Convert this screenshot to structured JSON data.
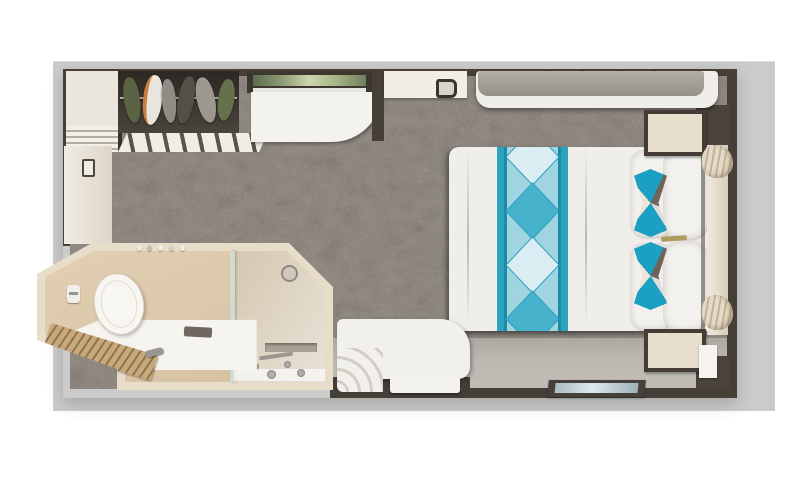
{
  "scene": {
    "kind": "cruise-stateroom-floorplan-3d-render",
    "areas": [
      "bedroom",
      "bathroom",
      "entry-vestibule"
    ],
    "contains_text": false
  },
  "palette": {
    "page_bg": "#ffffff",
    "deck_backdrop": "#cbcbca",
    "walls": "#463f38",
    "carpet": "#8e8780",
    "vinyl_floor": "#b7b2ac",
    "bathroom_wall": "#e8ddc9",
    "bathroom_floor": "#dcc8ad",
    "bed_linen": "#f0eeea",
    "runner_teal": "#2ba2be",
    "accent_teal": "#1b9fc2",
    "accent_taupe": "#6e6459",
    "wood": "#b99b6e",
    "sofa_cushion": "#a6a19b"
  },
  "elements": [
    {
      "name": "shelf-tower",
      "desc": "open shelving column beside closet"
    },
    {
      "name": "closet",
      "desc": "open wardrobe with six hanging garments on a rail"
    },
    {
      "name": "slat-doors",
      "desc": "louvered sliding closet doors"
    },
    {
      "name": "bathroom-door",
      "desc": "door panel with handle on left wall"
    },
    {
      "name": "mirror-art",
      "desc": "framed mirror strip above desk"
    },
    {
      "name": "desk",
      "desc": "white curved vanity desk"
    },
    {
      "name": "wall-cabinet",
      "desc": "counter with small kettle"
    },
    {
      "name": "sofa",
      "desc": "bench sofa along top wall with gray cushion"
    },
    {
      "name": "bed",
      "desc": "queen bed, white duvet, teal diamond runner, head at right"
    },
    {
      "name": "pillows",
      "desc": "two rows of white pillows with teal hourglass accent cushions"
    },
    {
      "name": "nightstand-top",
      "desc": "nightstand above bed head"
    },
    {
      "name": "nightstand-bottom",
      "desc": "nightstand below bed head"
    },
    {
      "name": "window-curtains",
      "desc": "window band on right wall with beige curtains"
    },
    {
      "name": "lounge-chair",
      "desc": "white curved chair with tiered arm"
    },
    {
      "name": "ottoman",
      "desc": "white footstool at bottom wall"
    },
    {
      "name": "entry-mat",
      "desc": "dark-framed threshold mat with steel-blue inset"
    },
    {
      "name": "toilet",
      "desc": "toilet with lid"
    },
    {
      "name": "vanity-sink",
      "desc": "bathroom counter with wooden slat tray, faucet, amenity tray"
    },
    {
      "name": "shower",
      "desc": "glass shower stall with drain, niche and chrome fixtures"
    }
  ]
}
